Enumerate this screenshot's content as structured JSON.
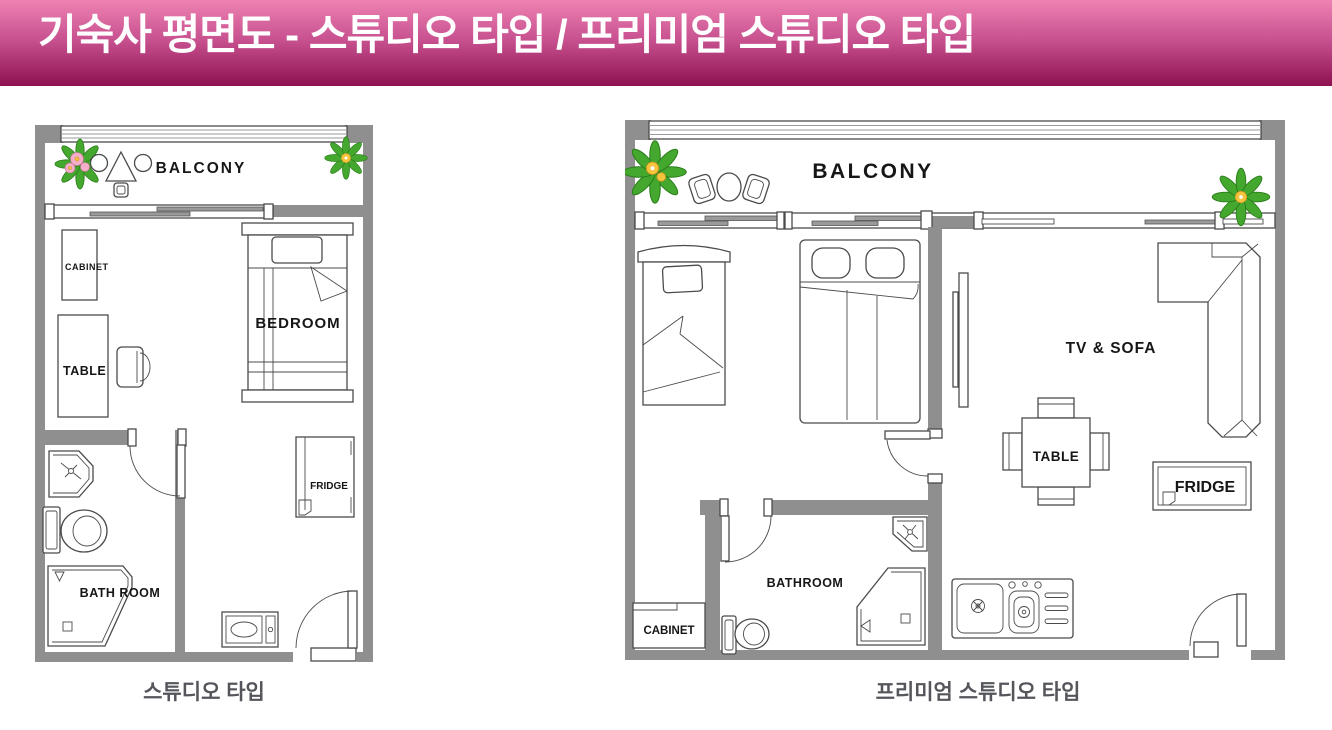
{
  "header": {
    "title": "기숙사 평면도 - 스튜디오 타입 / 프리미엄 스튜디오 타입"
  },
  "plans": {
    "studio": {
      "caption": "스튜디오 타입",
      "labels": {
        "balcony": "BALCONY",
        "cabinet": "CABINET",
        "table": "TABLE",
        "bedroom": "BEDROOM",
        "fridge": "FRIDGE",
        "bathroom": "BATH ROOM"
      }
    },
    "premium": {
      "caption": "프리미엄 스튜디오 타입",
      "labels": {
        "balcony": "BALCONY",
        "tv_sofa": "TV & SOFA",
        "table": "TABLE",
        "fridge": "FRIDGE",
        "bathroom": "BATHROOM",
        "cabinet": "CABINET"
      }
    }
  },
  "icons": [
    "plant-icon",
    "balcony-table-set-icon",
    "balcony-chair-icon",
    "sliding-window-icon",
    "single-bed-icon",
    "double-bed-icon",
    "desk-icon",
    "chair-icon",
    "cabinet-icon",
    "fridge-icon",
    "kitchenette-icon",
    "kitchen-sink-icon",
    "toilet-icon",
    "washbasin-icon",
    "shower-icon",
    "door-icon",
    "sofa-icon",
    "tv-icon",
    "dining-table-icon"
  ],
  "colors": {
    "banner_top": "#ee82b2",
    "banner_mid": "#c64f8e",
    "banner_bottom": "#8e1150",
    "wall": "#8f8f8f",
    "line": "#4b4b4b",
    "caption_text": "#54565b",
    "bar_fill": "#9a9a9a",
    "plant_green": "#44a82e",
    "plant_green_dark": "#2a7d1a",
    "flower_pink": "#f4aec9",
    "flower_yellow": "#f6c33c"
  }
}
